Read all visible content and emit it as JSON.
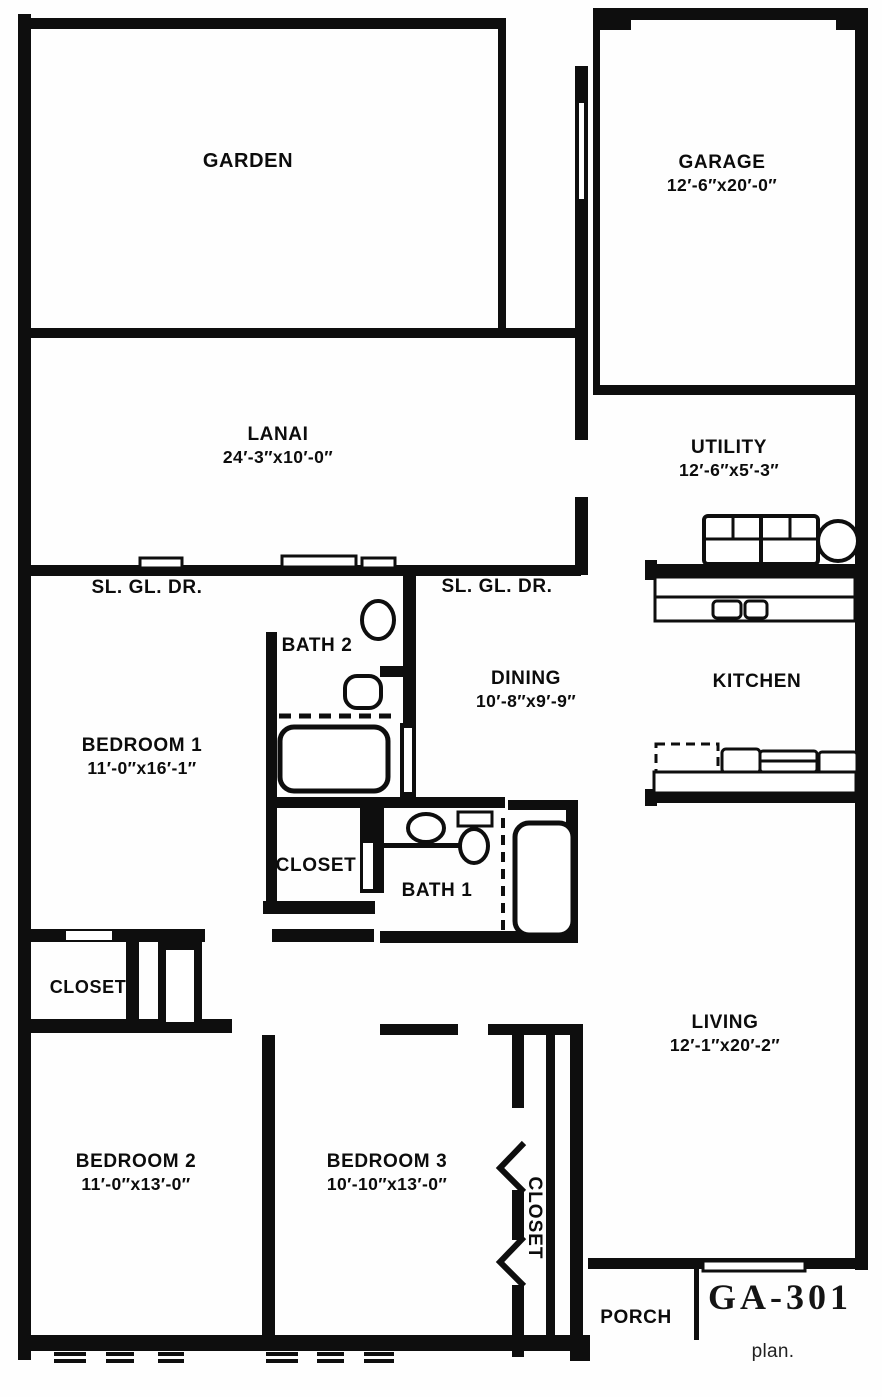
{
  "title_block": {
    "plan_code": "GA-301",
    "caption": "plan."
  },
  "rooms": {
    "garden": {
      "name": "GARDEN"
    },
    "garage": {
      "name": "GARAGE",
      "dims": "12′-6″x20′-0″"
    },
    "lanai": {
      "name": "LANAI",
      "dims": "24′-3″x10′-0″"
    },
    "utility": {
      "name": "UTILITY",
      "dims": "12′-6″x5′-3″"
    },
    "kitchen": {
      "name": "KITCHEN"
    },
    "dining": {
      "name": "DINING",
      "dims": "10′-8″x9′-9″"
    },
    "bath2": {
      "name": "BATH 2"
    },
    "bedroom1": {
      "name": "BEDROOM 1",
      "dims": "11′-0″x16′-1″"
    },
    "closet_hall": {
      "name": "CLOSET"
    },
    "bath1": {
      "name": "BATH 1"
    },
    "closet_left": {
      "name": "CLOSET"
    },
    "living": {
      "name": "LIVING",
      "dims": "12′-1″x20′-2″"
    },
    "bedroom2": {
      "name": "BEDROOM 2",
      "dims": "11′-0″x13′-0″"
    },
    "bedroom3": {
      "name": "BEDROOM 3",
      "dims": "10′-10″x13′-0″"
    },
    "closet_bedroom3": {
      "name": "CLOSET"
    },
    "porch": {
      "name": "PORCH"
    }
  },
  "door_labels": {
    "left": "SL. GL. DR.",
    "right": "SL. GL. DR."
  },
  "colors": {
    "ink": "#0e0e0e",
    "paper": "#fefefe"
  }
}
